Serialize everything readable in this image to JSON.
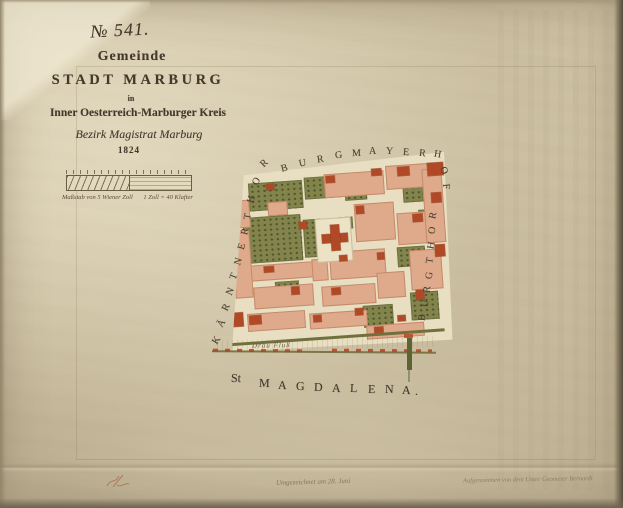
{
  "title_block": {
    "number": "№ 541.",
    "gemeinde": "Gemeinde",
    "city": "STADT MARBURG",
    "in_word": "in",
    "region": "Inner Oesterreich-Marburger Kreis",
    "district": "Bezirk Magistrat Marburg",
    "year": "1824"
  },
  "scale_bar": {
    "caption_left": "Maßstab von 5 Wiener Zoll",
    "caption_right": "1 Zoll = 40 Klafter"
  },
  "map_labels": {
    "top_arc": "BURGMAYERHOF",
    "left_edge": "KÄRNTNERTHOR",
    "right_edge": "BURGTHOR",
    "bottom": "St MAGDALENA.",
    "river": "Drau Fluß"
  },
  "footer": {
    "center_note": "Umgezeichnet am 28. Juni",
    "right_note": "Aufgenommen von dem Unter Geometer Bernardi"
  },
  "colors": {
    "paper": "#d3c7a9",
    "block_fill": "#dfa98b",
    "building_red": "#b04a26",
    "garden_green": "#83834c",
    "street": "#e8dec2",
    "ink": "#3f382c"
  }
}
